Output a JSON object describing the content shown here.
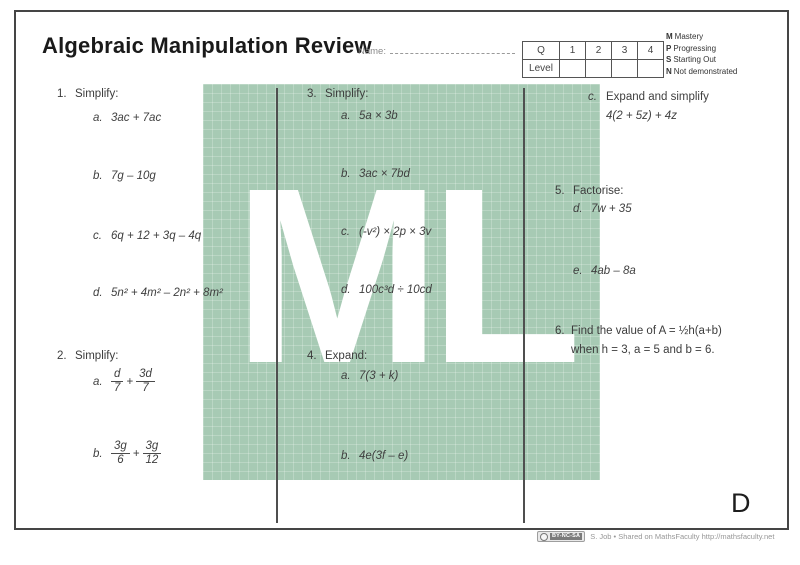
{
  "page": {
    "title": "Algebraic Manipulation Review",
    "name_label": "Name:",
    "corner_letter": "D"
  },
  "score_table": {
    "header": [
      "Q",
      "1",
      "2",
      "3",
      "4"
    ],
    "row_label": "Level"
  },
  "legend": {
    "items": [
      {
        "key": "M",
        "text": "Mastery"
      },
      {
        "key": "P",
        "text": "Progressing"
      },
      {
        "key": "S",
        "text": "Starting Out"
      },
      {
        "key": "N",
        "text": "Not demonstrated"
      }
    ]
  },
  "questions": {
    "q1": {
      "number": "1.",
      "prompt": "Simplify:",
      "items": [
        {
          "label": "a.",
          "expr": "3ac + 7ac"
        },
        {
          "label": "b.",
          "expr": "7g – 10g"
        },
        {
          "label": "c.",
          "expr": "6q + 12 + 3q – 4q"
        },
        {
          "label": "d.",
          "expr": "5n² + 4m² – 2n² + 8m²"
        }
      ]
    },
    "q2": {
      "number": "2.",
      "prompt": "Simplify:",
      "items": [
        {
          "label": "a.",
          "frac1_num": "d",
          "frac1_den": "7",
          "op": "+",
          "frac2_num": "3d",
          "frac2_den": "7"
        },
        {
          "label": "b.",
          "frac1_num": "3g",
          "frac1_den": "6",
          "op": "+",
          "frac2_num": "3g",
          "frac2_den": "12"
        }
      ]
    },
    "q3": {
      "number": "3.",
      "prompt": "Simplify:",
      "items": [
        {
          "label": "a.",
          "expr": "5a × 3b"
        },
        {
          "label": "b.",
          "expr": "3ac × 7bd"
        },
        {
          "label": "c.",
          "expr": "(-v²) × 2p × 3v"
        },
        {
          "label": "d.",
          "expr": "100c³d ÷ 10cd"
        }
      ]
    },
    "q4": {
      "number": "4.",
      "prompt": "Expand:",
      "items": [
        {
          "label": "a.",
          "expr": "7(3 + k)"
        },
        {
          "label": "b.",
          "expr": "4e(3f – e)"
        }
      ]
    },
    "q4c": {
      "label": "c.",
      "line1": "Expand and simplify",
      "line2": "4(2 + 5z) + 4z"
    },
    "q5": {
      "number": "5.",
      "prompt": "Factorise:",
      "items": [
        {
          "label": "d.",
          "expr": "7w + 35"
        },
        {
          "label": "e.",
          "expr": "4ab – 8a"
        }
      ]
    },
    "q6": {
      "number": "6.",
      "line1": "Find the value of  A = ½h(a+b)",
      "line2": "when h = 3, a = 5 and b = 6."
    }
  },
  "watermark": {
    "text": "ML",
    "green": "#a7cab4"
  },
  "footer": {
    "license": "BY-NC-SA",
    "credit": "S. Job • Shared on MathsFaculty http://mathsfaculty.net"
  }
}
